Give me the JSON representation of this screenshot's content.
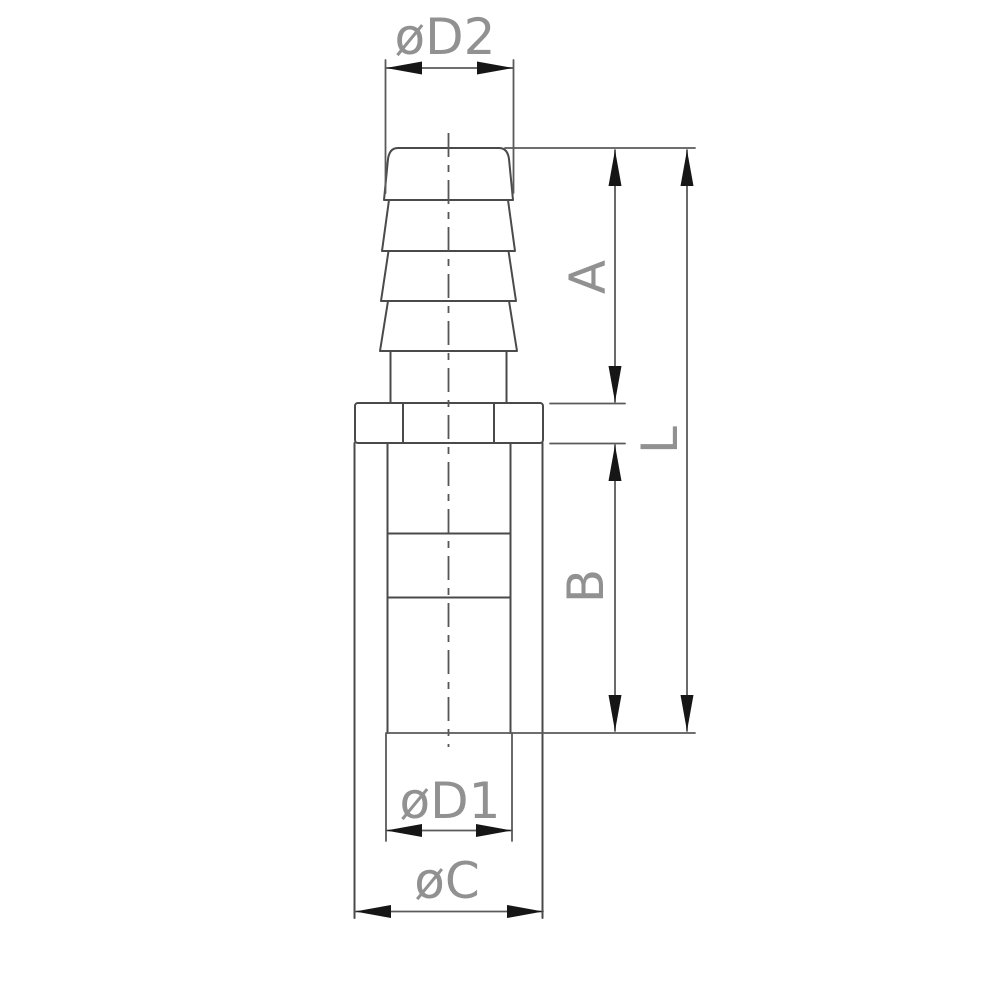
{
  "drawing": {
    "labels": {
      "top_diameter": "øD2",
      "barb_length": "A",
      "overall_length": "L",
      "body_length": "B",
      "inner_diameter": "øD1",
      "outer_diameter": "øC"
    },
    "colors": {
      "background": "#ffffff",
      "part_outline": "#4a4a4a",
      "dimension_line": "#5a5a5a",
      "arrowhead": "#161616",
      "label_text": "#919191"
    }
  }
}
